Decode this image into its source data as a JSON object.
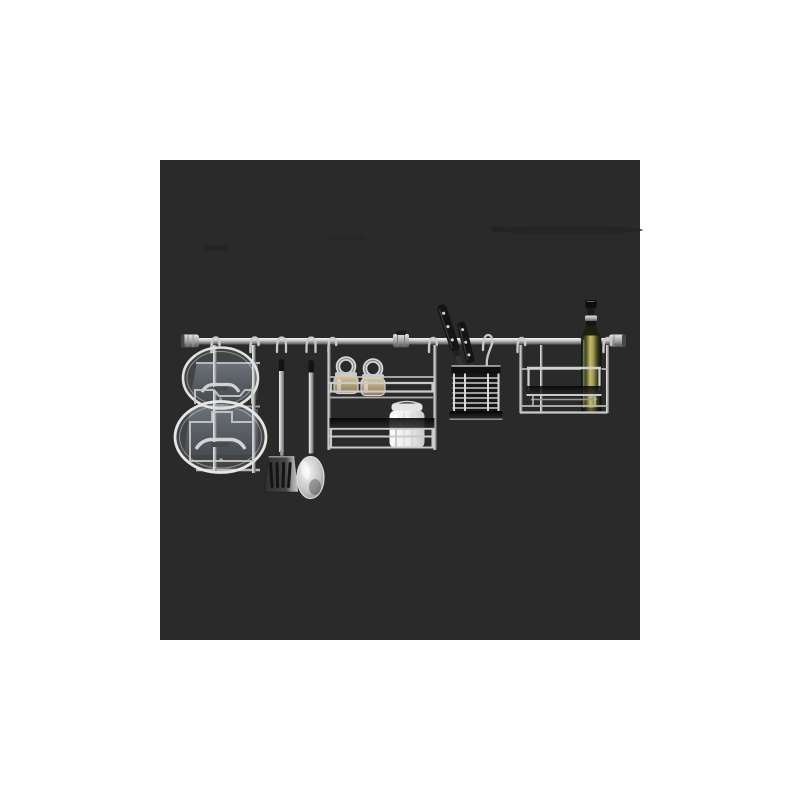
{
  "meta": {
    "type": "product-photograph",
    "alt": "Stainless steel kitchen wall rail organizer set on a dark gray square background: a rail with end caps holding a pot-lid rack with two glass lids, a hanging slotted spatula and serving spoon, a two-tier spice rack with two spice jars and a white preserving jar, a wire cutlery basket with two black-handled knives, and a bottle rack holding a green bottle of olive oil."
  },
  "colors": {
    "page-bg": "#ffffff",
    "square": "#2a2a2a",
    "smudge": "#242424",
    "steel-light": "#ededed",
    "steel-mid": "#b0b0b0",
    "steel-dark": "#5f5f5f",
    "black-part": "#141414",
    "panel-gray": "#4e535a",
    "shelf-dark": "#0c0c0c",
    "spice-fill": "#c2ab7f",
    "jar-white": "#efefef",
    "bottle-dark": "#171a0b",
    "bottle-olive": "#c0b869",
    "blade-gray": "#3c3c3c"
  },
  "scene": {
    "background": "dark gray centered square on white page",
    "items": [
      {
        "name": "wall-rail",
        "description": "horizontal stainless rail with cylindrical end caps and a center mounting sleeve"
      },
      {
        "name": "pot-lid-rack",
        "description": "wire rack holding two round glass pot lids with steel rims and handles"
      },
      {
        "name": "spatula",
        "description": "slotted turner hanging from an S-hook, steel handle with black cap"
      },
      {
        "name": "serving-spoon",
        "description": "steel serving spoon hanging from an S-hook"
      },
      {
        "name": "spice-rack",
        "description": "two-tier wire spice shelf with dark glass shelf"
      },
      {
        "name": "spice-jar-1",
        "description": "small glass spice jar with steel ring lid, tan contents"
      },
      {
        "name": "spice-jar-2",
        "description": "small glass spice jar with steel ring lid, tan contents"
      },
      {
        "name": "preserve-jar",
        "description": "white frosted clamp-lid preserving jar on lower shelf"
      },
      {
        "name": "knife-1",
        "description": "black-handled kitchen knife with rivets leaning in basket"
      },
      {
        "name": "knife-2",
        "description": "black-handled kitchen knife with rivets leaning in basket"
      },
      {
        "name": "cutlery-basket",
        "description": "hanging wire mesh utensil basket with dark base"
      },
      {
        "name": "bottle-rack",
        "description": "wire bottle shelf with dark glass insert and front guard rail"
      },
      {
        "name": "oil-bottle",
        "description": "tall green glass olive-oil bottle with black pour spout and silver collar"
      }
    ]
  }
}
